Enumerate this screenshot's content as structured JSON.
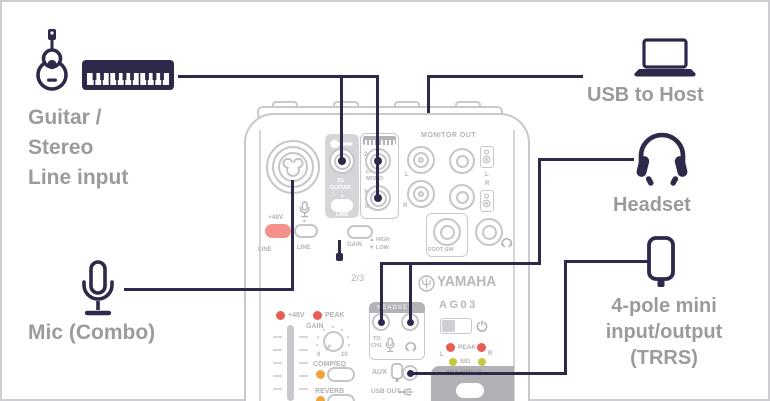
{
  "callouts": {
    "guitar": {
      "line1": "Guitar /",
      "line2": "Stereo",
      "line3": "Line input"
    },
    "usb": {
      "label": "USB to Host"
    },
    "headset": {
      "label": "Headset"
    },
    "mic": {
      "label": "Mic (Combo)"
    },
    "trrs": {
      "line1": "4-pole mini",
      "line2": "input/output",
      "line3": "(TRRS)"
    }
  },
  "mixer": {
    "brand": "YAMAHA",
    "model": "AG03",
    "channel": "2/3",
    "combo": {
      "phantom": "+48V",
      "line_a": "LINE",
      "line_b": "LINE",
      "arrow": "▲"
    },
    "guitar_section": {
      "l1": "2G",
      "l2": "GUITAR",
      "arrow": "▲",
      "line": "LINE"
    },
    "stereo_section": {
      "jack2": "2",
      "jack2_sub": "L/",
      "jack2_sub2": "MONO",
      "jack3": "3",
      "jack3_sub": "R",
      "gain": "GAIN",
      "high": "▲ HIGH",
      "low": "▼ LOW"
    },
    "monitor": {
      "title": "MONITOR OUT",
      "rca_l": "L",
      "rca_r": "R",
      "ph_l": "L",
      "ph_r": "R",
      "foot": "FOOT SW"
    },
    "strip": {
      "phantom": "+48V",
      "peak": "PEAK",
      "gain": "GAIN",
      "k0": "0",
      "k10": "10",
      "comp": "COMP/EQ",
      "reverb": "REVERB"
    },
    "headset_section": {
      "title": "HEADSET",
      "to": "TO",
      "ch1": "CH1"
    },
    "meter": {
      "peak": "PEAK",
      "sig": "SIG",
      "l": "L",
      "r": "R"
    },
    "io": {
      "aux": "AUX",
      "usb_out": "USB OUT",
      "mix_minus": "MIX MINUS"
    }
  },
  "colors": {
    "callout_line": "#2e294a",
    "callout_label": "#9b9b9b",
    "sketch": "#c6c6ca",
    "phantom_switch_red": "#f4918b",
    "led_red": "#e95c54",
    "led_orange": "#f0a43c",
    "led_olive": "#c6c83f"
  }
}
